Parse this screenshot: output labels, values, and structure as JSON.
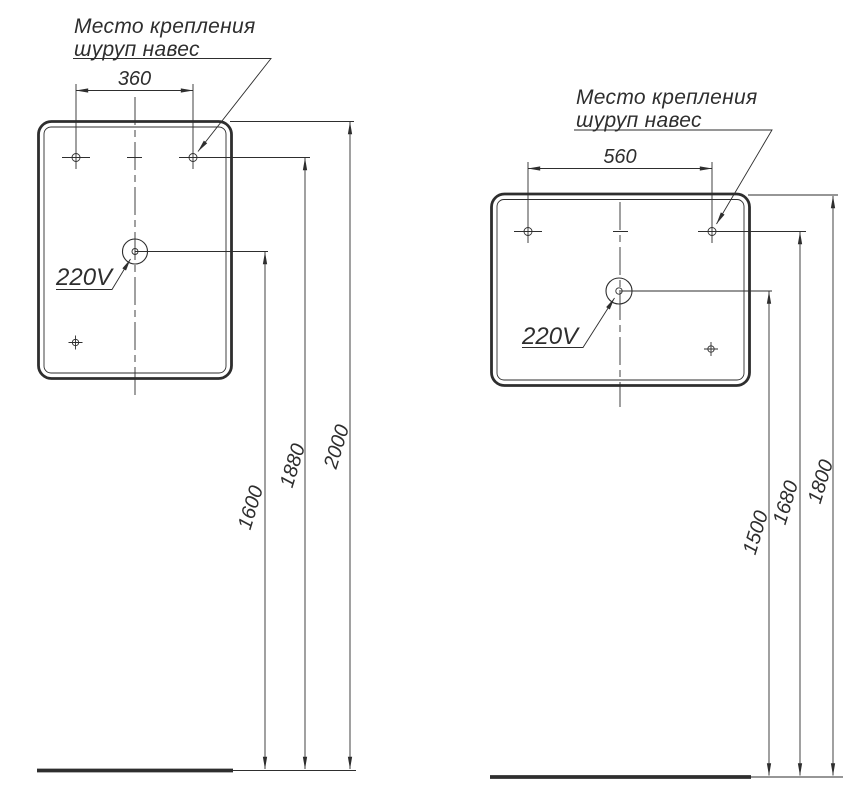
{
  "colors": {
    "line": "#2e2e2e",
    "background": "#ffffff"
  },
  "left_view": {
    "label_line1": "Место крепления",
    "label_line2": "шуруп навес",
    "hole_spacing": "360",
    "outlet_label": "220V",
    "dim_outlet_height": "1600",
    "dim_holes_height": "1880",
    "dim_top_height": "2000"
  },
  "right_view": {
    "label_line1": "Место крепления",
    "label_line2": "шуруп навес",
    "hole_spacing": "560",
    "outlet_label": "220V",
    "dim_outlet_height": "1500",
    "dim_holes_height": "1680",
    "dim_top_height": "1800"
  }
}
